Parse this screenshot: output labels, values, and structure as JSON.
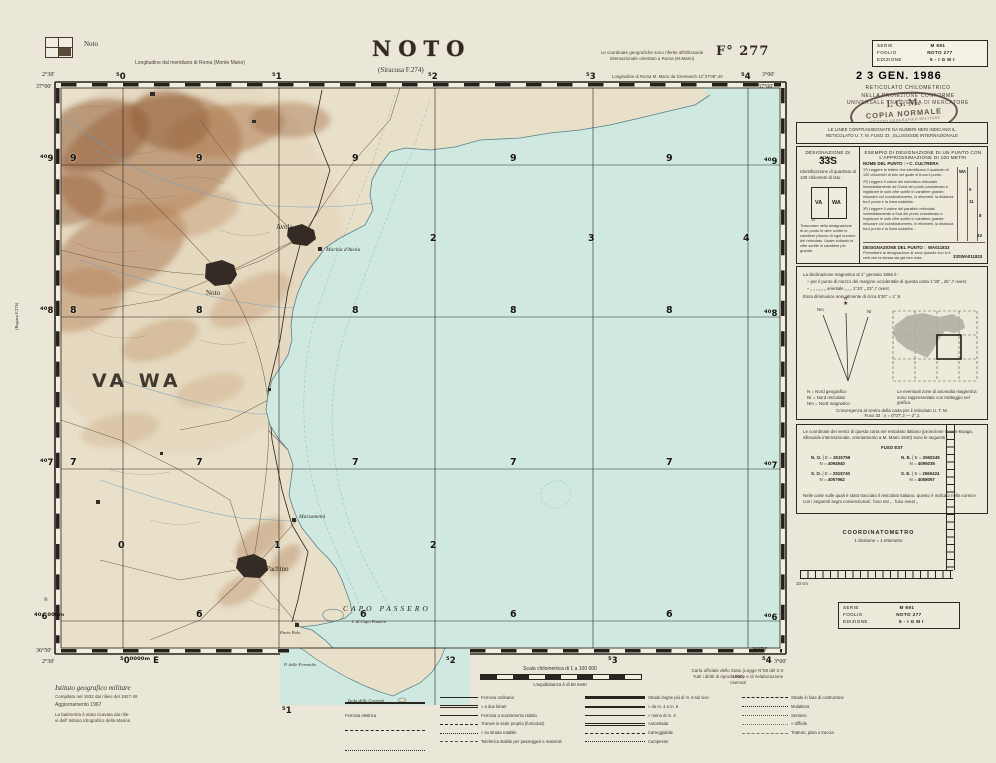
{
  "header": {
    "index_label": "Noto",
    "title": "NOTO",
    "subtitle": "(Siracusa F.274)",
    "meridian_note": "Longitudine dal meridiano di Roma  (Monte Mario)",
    "coord_note_1": "Le coordinate geografiche sono riferite all'Ellissoide",
    "coord_note_2": "internazionale orientato a Roma (M.Mario)",
    "sheet_number": "F° 277",
    "greenwich_note": "Longitudine di Roma M. Mario da Greenwich 12°27'08\",40"
  },
  "serie": {
    "s": "SERIE",
    "sv": "M 691",
    "f": "FOGLIO",
    "fv": "NOTO 277",
    "e": "EDIZIONE",
    "ev": "5   - I G M I"
  },
  "stamps": {
    "date": "2 3 GEN. 1986",
    "ret1": "RETICOLATO CHILOMETRICO",
    "ret2": "NELLA PROIEZIONE CONFORME",
    "ret3": "UNIVERSALE TRASVERSA DI MERCATORE",
    "oval_top": "I. G. M.",
    "oval_main": "COPIA NORMALE",
    "oval_bottom": "ISTITUTO GEOGRAFICO MILITARE"
  },
  "panel": {
    "utm_note1": "LE LINEE CONTRASSEGNATE DA NUMERI NERI INDICANO IL",
    "utm_note2": "RETICOLATO U. T. M. FUSO 33 , ELLISSOIDE INTERNAZIONALE",
    "des": {
      "zona_label": "DESIGNAZIONE DI ZONA :",
      "zona_value": "33S",
      "square_note": "Identificazione di quadrato di 100 chilometri di lato :",
      "va": "VA",
      "wa": "WA",
      "ten": "10",
      "footnote": "Trascurare nella designazione di un punto le cifre scritte in carattere piccolo di ogni numero del reticolato. Usare soltanto le cifre scritte in carattere più grande.",
      "esempio": "ESEMPIO DI DESIGNAZIONE DI UN PUNTO CON L'APPROSSIMAZIONE DI 100 METRI",
      "nome_label": "NOME DEL PUNTO :",
      "nome_value": "• C. CULTRERA",
      "s1": "1ª) Leggere le lettere che identificano il quadrato di 100 chilometri di lato nel quale si trova il punto :",
      "s1v": "WA",
      "s2": "2ª) Leggere il valore del meridiano reticolato immediatamente ad Ovest del punto considerato e registrare le sole cifre scritte in carattere grande; misurare col coordinatometro, in ettometri, la distanza fra il punto e la linea suddetta :",
      "s2v1": "0",
      "s2v2": "11",
      "s3": "3ª) Leggere il valore del parallelo reticolato immediatamente a Sud del punto considerato e registrare le sole cifre scritte in carattere grande; misurare col coordinatometro, in ettometri, la distanza fra il punto e la linea suddetta :",
      "s3v1": "8",
      "s3v2": "33",
      "dp_label": "DESIGNAZIONE DEL PUNTO :",
      "dp_value": "WA011833",
      "pre": "Premettere la designazione di zona quando non si è certi che la stessa sia già ben nota :",
      "pre_value": "33SWA011833"
    },
    "dec": {
      "l1": "La declinazione magnetica al 1° gennaio 1966 è :",
      "l2": "– per il punto di mezzo del margine occidentale di questa carta 1°30' „ 26°,7 ovest.",
      "l3": "–  „  „  „  „  „  „  orientale  „  „  „  1°20' „ 23°,7 ovest.",
      "l4": "Essa diminuisce annualmente di circa  6'30\" = 1°,9",
      "nm": "Nm",
      "n": "N",
      "nr": "Nr",
      "star": "★",
      "g1": "N  =  Nord geografico",
      "g2": "Nr =  Nord reticolato",
      "g3": "Nm =  Nord magnetico",
      "anomaly": "Le eventuali zone di anomalia magnetica sono rappresentate con tratteggio nel grafico.",
      "conv1": "Convergenza al centro della carta per il reticolato  U. T. M.",
      "conv2": "Fuso 33 :   γ = 0°07',2 — 2°,1"
    },
    "coo": {
      "intro": "Le coordinate dei vertici di questa carta nel reticolato italiano (proiezione Gauss-Boaga, ellissoide internazionale, orientamento a M. Mario 1940) sono le seguenti :",
      "fuso": "FUSO EST",
      "no_l": "N. O.",
      "ne_l": "N. E.",
      "so_l": "S. O.",
      "se_l": "S. E.",
      "e_eq": "E =",
      "n_eq": "N =",
      "no_e": "2515759",
      "no_n": "4094940",
      "ne_e": "2560249",
      "ne_n": "4095035",
      "so_e": "2515740",
      "so_n": "4057962",
      "se_e": "2560424",
      "se_n": "4058057",
      "note": "Nelle carte sulle quali è stato tracciato il reticolato italiano, questo è indicato nella cornice con i seguenti segni convenzionali :  fuso est „   .  fuso ovest „"
    },
    "coordinatometro": "COORDINATOMETRO",
    "divisione": "1 divisione  =  1 ettometro",
    "cm10": "10 cm"
  },
  "edge": {
    "tl_lon": "2°30'",
    "tl_lat": "37°00'",
    "t0": "⁵0",
    "t1": "⁵1",
    "t2": "⁵2",
    "t3": "⁵3",
    "t4": "⁵4",
    "tr_lon": "3°00'",
    "tr_lat": "37°00'",
    "l9": "⁴⁰9",
    "l8": "⁴⁰8",
    "l7": "⁴⁰7",
    "n_label": "N",
    "l6": "⁴⁰6⁰⁰⁰ᵐ",
    "ragusa": "(Ragusa F.276)",
    "bl_lat": "36°50'",
    "bl_lon": "2°30'",
    "b0": "⁵0⁰⁰⁰⁰ᵐ E",
    "b1": "⁵1",
    "b2": "⁵2",
    "b3": "⁵3",
    "b4": "⁵4",
    "br_lat": "36°50'",
    "br_lon": "3°00'",
    "r9": "⁴⁰9",
    "r8": "⁴⁰8",
    "r7": "⁴⁰7",
    "r6": "⁴⁰6"
  },
  "map": {
    "n9": "9",
    "n8": "8",
    "n7": "7",
    "n6": "6",
    "c0": "0",
    "c1": "1",
    "c2": "2",
    "c3": "3",
    "c4": "4",
    "vawa": "VA WA",
    "avola": "Avola",
    "marina_avola": "Marina d'Avola",
    "noto": "Noto",
    "marzamemi": "Marzamemi",
    "pachino": "Pachino",
    "capo_passero": "CAPO PASSERO",
    "i_capo_passero": "I. di Capo Passero",
    "porto_palo": "Porto Palo",
    "formiche": "P. delle Formiche",
    "correnti": "Isola delle Correnti"
  },
  "bottom": {
    "istituto": "Istituto geografico militare",
    "compilato": "Compilato nel 1932 dai rilievi del 1927-28",
    "aggiornamento": "Aggiornamento   1967",
    "bat1": "La batimetria è stata ricavata dai rilie-",
    "bat2": "vi dell' Istituto Idrografico della Marina",
    "scala": "Scala chilometrica di 1 a 100 000",
    "equi": "L'equidistanza è di 50 metri",
    "carta1": "Carta ufficiale dello Stato (Legge N°68 del 2-2-1960)",
    "carta2": "Tutti i diritti di riproduzione e di rielaborazione riservati",
    "ferrovia_el": "Ferrovia elettrica",
    "limiti_label": "Limiti di",
    "lim1": "Stato",
    "lim2": "provincia",
    "lim3": "comune",
    "fer1": "Ferrovia ordinaria",
    "fer2": "»  a due binari",
    "fer3": "Ferrovia a scartamento ridotto",
    "fer4": "Tranvie in sede propria (funicolari)",
    "fer5": "»  su strada rotabile",
    "fer6": "Teleferica stabile per passeggeri e materiali",
    "str1": "Strade larghe più di m. 6 sul vivo",
    "str2": "»  da m. 4 a m. 6",
    "str3": "»  meno di m. 4",
    "str4": "Autostrada",
    "str5": "Carreggiabile",
    "str6": "Campestre",
    "sen1": "Strade in fase di costruzione",
    "sen2": "Mulattiera",
    "sen3": "Sentiero",
    "sen4": "»  difficile",
    "sen5": "Tratturo, pista o traccia"
  }
}
